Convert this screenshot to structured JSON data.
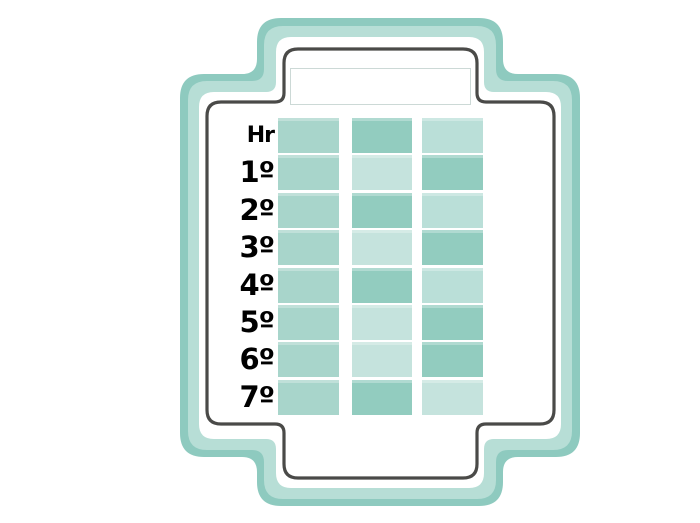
{
  "frame": {
    "title_box": {
      "value": ""
    }
  },
  "palette": {
    "frame_outer": "#8ecabf",
    "frame_inner": "#b7ded6",
    "outline": "#4a4a48",
    "background": "#ffffff",
    "title_box_border": "#ccd9d6",
    "label_color": "#000000",
    "cell_tones": {
      "medium": "#a8d5cb",
      "dark": "#92ccbf",
      "light": "#c5e3dd",
      "soft": "#badfd8"
    }
  },
  "schedule": {
    "columns": 3,
    "rows": [
      {
        "label": "Hr",
        "cells": [
          "medium",
          "dark",
          "soft"
        ]
      },
      {
        "label": "1º",
        "cells": [
          "medium",
          "light",
          "dark"
        ]
      },
      {
        "label": "2º",
        "cells": [
          "medium",
          "dark",
          "soft"
        ]
      },
      {
        "label": "3º",
        "cells": [
          "medium",
          "light",
          "dark"
        ]
      },
      {
        "label": "4º",
        "cells": [
          "medium",
          "dark",
          "soft"
        ]
      },
      {
        "label": "5º",
        "cells": [
          "medium",
          "light",
          "dark"
        ]
      },
      {
        "label": "6º",
        "cells": [
          "medium",
          "light",
          "dark"
        ]
      },
      {
        "label": "7º",
        "cells": [
          "medium",
          "dark",
          "light"
        ]
      }
    ]
  }
}
